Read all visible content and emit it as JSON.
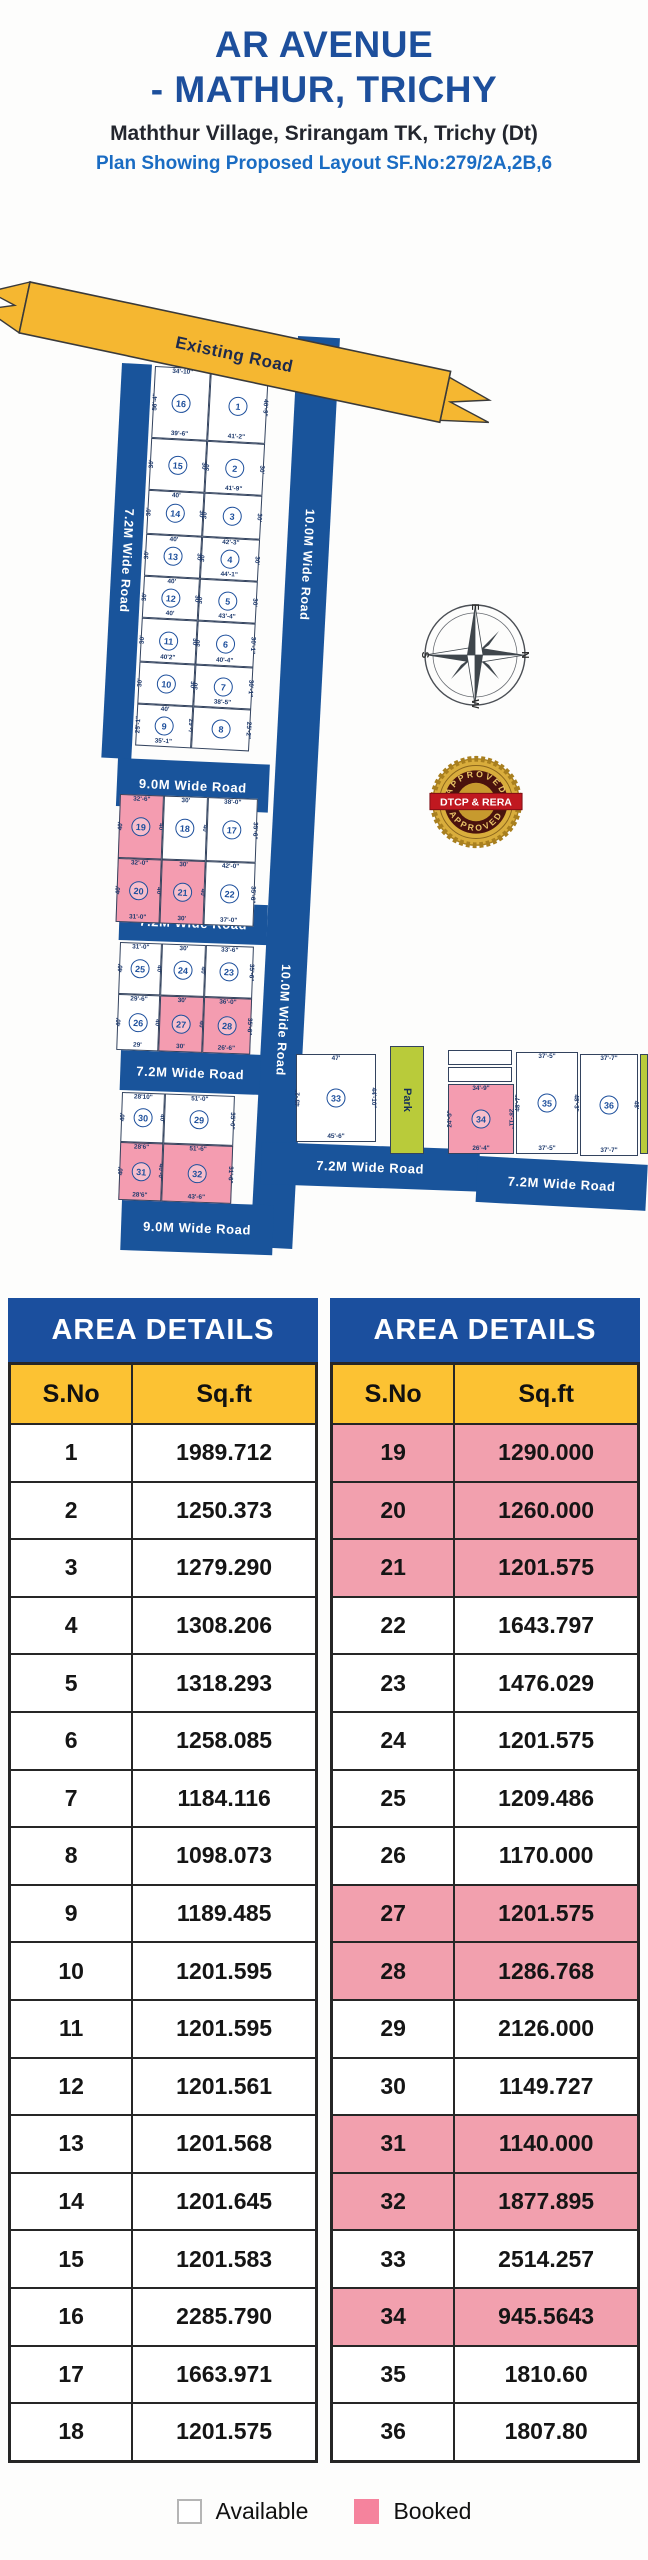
{
  "header": {
    "title_line1": "AR AVENUE",
    "title_line2": "- MATHUR, TRICHY",
    "subtitle": "Maththur Village, Srirangam TK, Trichy (Dt)",
    "plan_line": "Plan Showing Proposed Layout SF.No:279/2A,2B,6"
  },
  "plan": {
    "roads": {
      "existing": "Existing Road",
      "w72": "7.2M Wide Road",
      "w9": "9.0M Wide Road",
      "w10": "10.0M Wide Road"
    },
    "park_label": "Park",
    "compass": {
      "n": "N",
      "s": "S",
      "e": "E",
      "w": "W"
    },
    "seal": {
      "top": "APPROVED",
      "middle": "DTCP & RERA",
      "bottom": "APPROVED"
    },
    "plots": [
      {
        "no": "1",
        "booked": false,
        "dims": {
          "t": "34'-6\"",
          "r": "40'-9\"",
          "b": "41'-2\""
        }
      },
      {
        "no": "2",
        "booked": false,
        "dims": {
          "l": "30'",
          "r": "30'",
          "b": "41'-9\""
        }
      },
      {
        "no": "3",
        "booked": false,
        "dims": {
          "l": "30'",
          "r": "30'"
        }
      },
      {
        "no": "4",
        "booked": false,
        "dims": {
          "t": "42'-3\"",
          "l": "30'",
          "r": "30'",
          "b": "44'-1\""
        }
      },
      {
        "no": "5",
        "booked": false,
        "dims": {
          "l": "30'",
          "r": "30'",
          "b": "43'-4\""
        }
      },
      {
        "no": "6",
        "booked": false,
        "dims": {
          "l": "30'",
          "r": "30'-1\"",
          "b": "40'-4\""
        }
      },
      {
        "no": "7",
        "booked": false,
        "dims": {
          "l": "30'",
          "r": "30'-1\"",
          "b": "38'-5\""
        }
      },
      {
        "no": "8",
        "booked": false,
        "dims": {
          "r": "25'-2\""
        }
      },
      {
        "no": "9",
        "booked": false,
        "dims": {
          "t": "40'",
          "l": "25'-1\"",
          "r": "29'-7\"",
          "b": "35'-1\""
        }
      },
      {
        "no": "10",
        "booked": false,
        "dims": {
          "l": "30'",
          "r": "30'"
        }
      },
      {
        "no": "11",
        "booked": false,
        "dims": {
          "l": "30'",
          "r": "30'",
          "b": "40'2\""
        }
      },
      {
        "no": "12",
        "booked": false,
        "dims": {
          "t": "40'",
          "l": "30'",
          "r": "30'",
          "b": "40'"
        }
      },
      {
        "no": "13",
        "booked": false,
        "dims": {
          "t": "40'",
          "l": "30'",
          "r": "30'"
        }
      },
      {
        "no": "14",
        "booked": false,
        "dims": {
          "t": "40'",
          "l": "30'",
          "r": "30'"
        }
      },
      {
        "no": "15",
        "booked": false,
        "dims": {
          "l": "30'",
          "r": "30'"
        }
      },
      {
        "no": "16",
        "booked": false,
        "dims": {
          "t": "34'-10\"",
          "l": "56'-4\"",
          "b": "39'-6\""
        }
      },
      {
        "no": "17",
        "booked": false,
        "dims": {
          "t": "38'-0\"",
          "r": "35'-6\""
        }
      },
      {
        "no": "18",
        "booked": false,
        "dims": {
          "t": "30'",
          "r": "40'"
        }
      },
      {
        "no": "19",
        "booked": true,
        "dims": {
          "t": "32'-6\"",
          "l": "40'",
          "r": "40'"
        }
      },
      {
        "no": "20",
        "booked": true,
        "dims": {
          "t": "32'-0\"",
          "l": "40'",
          "r": "40'",
          "b": "31'-0\""
        }
      },
      {
        "no": "21",
        "booked": true,
        "dims": {
          "t": "30'",
          "r": "40'",
          "b": "30'"
        }
      },
      {
        "no": "22",
        "booked": false,
        "dims": {
          "t": "42'-0\"",
          "r": "35'-6\"",
          "b": "37'-0\""
        }
      },
      {
        "no": "23",
        "booked": false,
        "dims": {
          "t": "33'-6\"",
          "r": "35'-6\""
        }
      },
      {
        "no": "24",
        "booked": false,
        "dims": {
          "t": "30'",
          "r": "40'"
        }
      },
      {
        "no": "25",
        "booked": false,
        "dims": {
          "t": "31'-0\"",
          "l": "40'",
          "r": "40'"
        }
      },
      {
        "no": "26",
        "booked": false,
        "dims": {
          "t": "29'-6\"",
          "l": "40'",
          "r": "40'",
          "b": "29'"
        }
      },
      {
        "no": "27",
        "booked": true,
        "dims": {
          "t": "30'",
          "r": "40'",
          "b": "30'"
        }
      },
      {
        "no": "28",
        "booked": true,
        "dims": {
          "t": "36'-0\"",
          "r": "35'-6\"",
          "b": "26'-6\""
        }
      },
      {
        "no": "29",
        "booked": false,
        "dims": {
          "t": "51'-0\"",
          "r": "35'-0\""
        }
      },
      {
        "no": "30",
        "booked": false,
        "dims": {
          "t": "28'10\"",
          "l": "40'",
          "r": "40'"
        }
      },
      {
        "no": "31",
        "booked": true,
        "dims": {
          "t": "28'6\"",
          "l": "40'",
          "r": "40'-0\"",
          "b": "28'6\""
        }
      },
      {
        "no": "32",
        "booked": true,
        "dims": {
          "t": "51'-6\"",
          "r": "31'-6\"",
          "b": "43'-6\""
        }
      },
      {
        "no": "33",
        "booked": false,
        "dims": {
          "t": "47'",
          "l": "45'-2\"",
          "r": "44'-10\"",
          "b": "45'-6\""
        }
      },
      {
        "no": "34",
        "booked": true,
        "dims": {
          "t": "34'-9\"",
          "l": "24'-5\"",
          "r": "28'-11\"",
          "b": "26'-4\""
        }
      },
      {
        "no": "35",
        "booked": false,
        "dims": {
          "t": "37'-5\"",
          "l": "48'-7\"",
          "r": "48'-3\"",
          "b": "37'-5\""
        }
      },
      {
        "no": "36",
        "booked": false,
        "dims": {
          "t": "37'-7\"",
          "r": "48'",
          "b": "37'-7\""
        }
      }
    ]
  },
  "tables": {
    "left": {
      "title": "AREA DETAILS",
      "col_sno": "S.No",
      "col_sqft": "Sq.ft",
      "rows": [
        {
          "no": "1",
          "sqft": "1989.712",
          "booked": false
        },
        {
          "no": "2",
          "sqft": "1250.373",
          "booked": false
        },
        {
          "no": "3",
          "sqft": "1279.290",
          "booked": false
        },
        {
          "no": "4",
          "sqft": "1308.206",
          "booked": false
        },
        {
          "no": "5",
          "sqft": "1318.293",
          "booked": false
        },
        {
          "no": "6",
          "sqft": "1258.085",
          "booked": false
        },
        {
          "no": "7",
          "sqft": "1184.116",
          "booked": false
        },
        {
          "no": "8",
          "sqft": "1098.073",
          "booked": false
        },
        {
          "no": "9",
          "sqft": "1189.485",
          "booked": false
        },
        {
          "no": "10",
          "sqft": "1201.595",
          "booked": false
        },
        {
          "no": "11",
          "sqft": "1201.595",
          "booked": false
        },
        {
          "no": "12",
          "sqft": "1201.561",
          "booked": false
        },
        {
          "no": "13",
          "sqft": "1201.568",
          "booked": false
        },
        {
          "no": "14",
          "sqft": "1201.645",
          "booked": false
        },
        {
          "no": "15",
          "sqft": "1201.583",
          "booked": false
        },
        {
          "no": "16",
          "sqft": "2285.790",
          "booked": false
        },
        {
          "no": "17",
          "sqft": "1663.971",
          "booked": false
        },
        {
          "no": "18",
          "sqft": "1201.575",
          "booked": false
        }
      ]
    },
    "right": {
      "title": "AREA DETAILS",
      "col_sno": "S.No",
      "col_sqft": "Sq.ft",
      "rows": [
        {
          "no": "19",
          "sqft": "1290.000",
          "booked": true
        },
        {
          "no": "20",
          "sqft": "1260.000",
          "booked": true
        },
        {
          "no": "21",
          "sqft": "1201.575",
          "booked": true
        },
        {
          "no": "22",
          "sqft": "1643.797",
          "booked": false
        },
        {
          "no": "23",
          "sqft": "1476.029",
          "booked": false
        },
        {
          "no": "24",
          "sqft": "1201.575",
          "booked": false
        },
        {
          "no": "25",
          "sqft": "1209.486",
          "booked": false
        },
        {
          "no": "26",
          "sqft": "1170.000",
          "booked": false
        },
        {
          "no": "27",
          "sqft": "1201.575",
          "booked": true
        },
        {
          "no": "28",
          "sqft": "1286.768",
          "booked": true
        },
        {
          "no": "29",
          "sqft": "2126.000",
          "booked": false
        },
        {
          "no": "30",
          "sqft": "1149.727",
          "booked": false
        },
        {
          "no": "31",
          "sqft": "1140.000",
          "booked": true
        },
        {
          "no": "32",
          "sqft": "1877.895",
          "booked": true
        },
        {
          "no": "33",
          "sqft": "2514.257",
          "booked": false
        },
        {
          "no": "34",
          "sqft": "945.5643",
          "booked": true
        },
        {
          "no": "35",
          "sqft": "1810.60",
          "booked": false
        },
        {
          "no": "36",
          "sqft": "1807.80",
          "booked": false
        }
      ]
    }
  },
  "legend": {
    "available": "Available",
    "booked": "Booked"
  },
  "colors": {
    "navy_title": "#1d4f9c",
    "plan_line_blue": "#1a6cc3",
    "road_blue": "#19549b",
    "banner_yellow": "#f5b731",
    "table_header_blue": "#1b4f9e",
    "table_header_yellow": "#fcc233",
    "booked_pink": "#f2a0ae",
    "park_green": "#b9cb3a",
    "seal_gold": "#c79a2e",
    "seal_red": "#c01820"
  }
}
